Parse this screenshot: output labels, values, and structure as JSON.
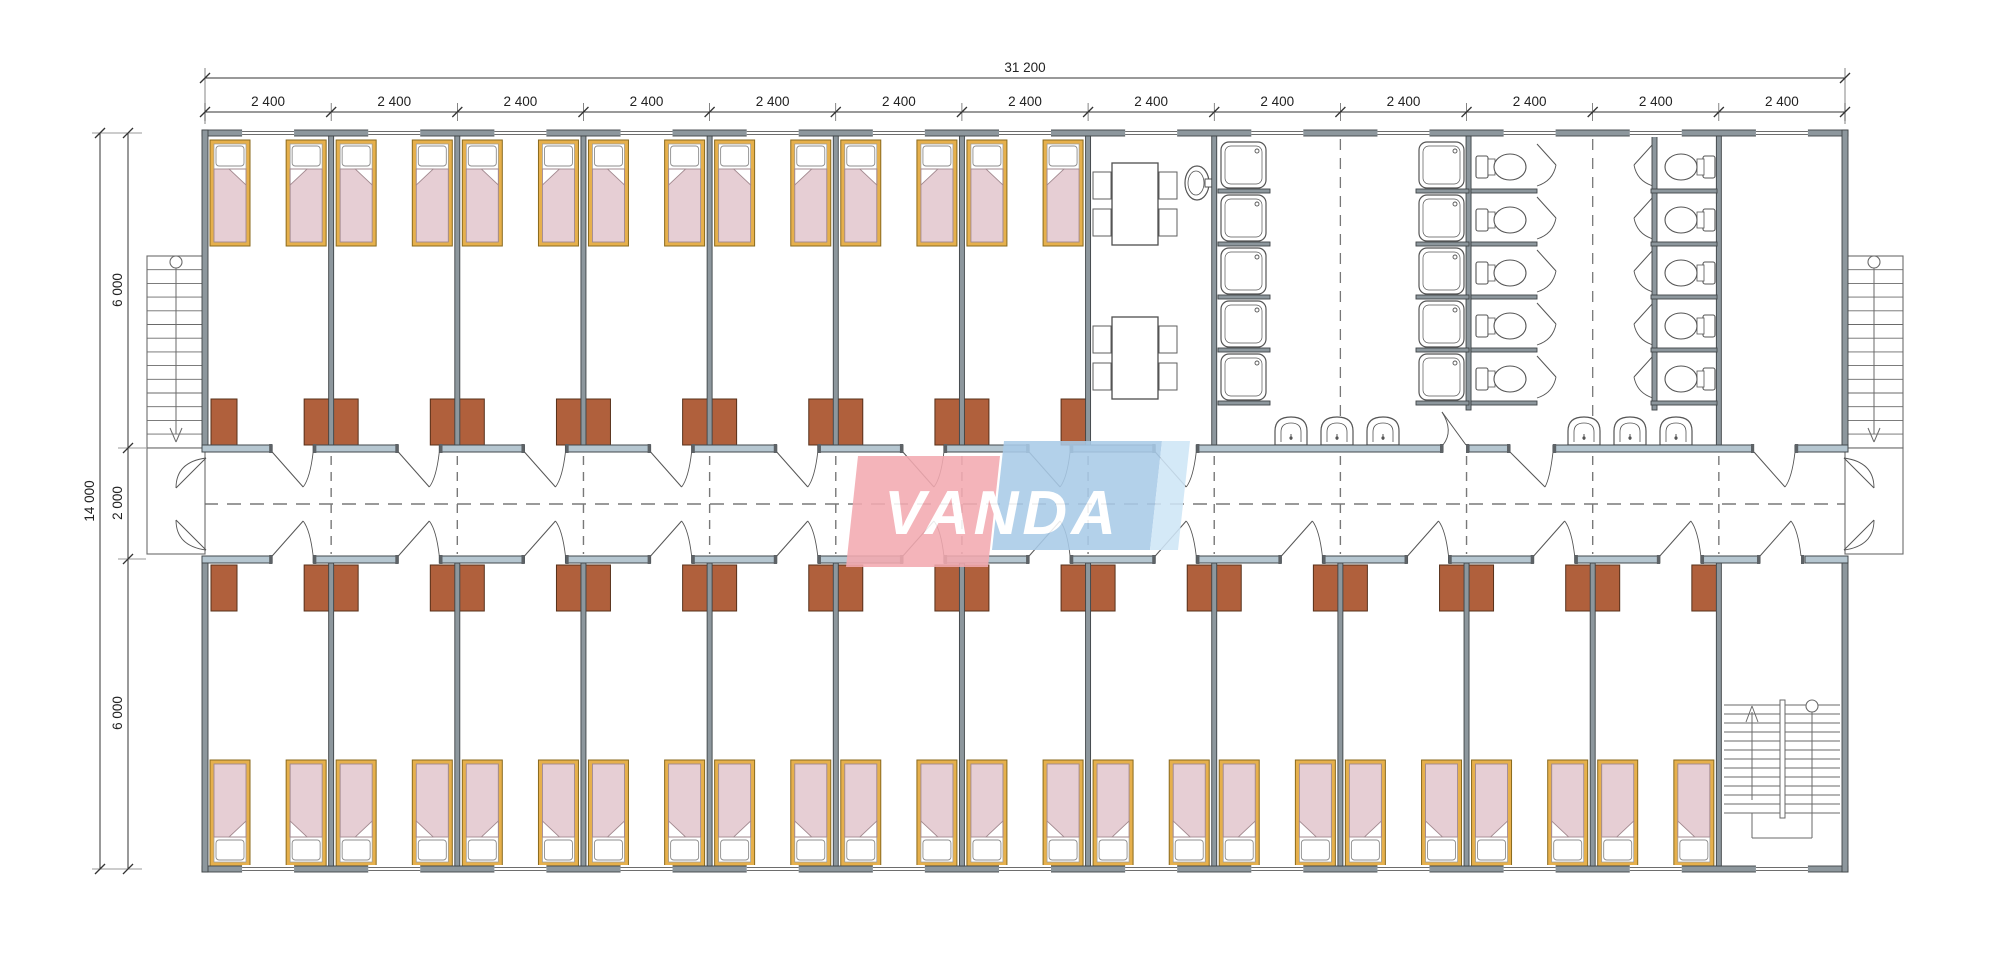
{
  "page": {
    "background": "#ffffff",
    "description": "architectural floor plan of modular dormitory building"
  },
  "logo": {
    "text": "VANDA",
    "red": "#f3aab1",
    "blue": "#a9cbe8",
    "light_blue": "#cfe6f7"
  },
  "dimensions": {
    "top_total": "31 200",
    "modules": [
      "2 400",
      "2 400",
      "2 400",
      "2 400",
      "2 400",
      "2 400",
      "2 400",
      "2 400",
      "2 400",
      "2 400",
      "2 400",
      "2 400",
      "2 400"
    ],
    "left_total": "14 000",
    "left_chain": [
      "6 000",
      "2 000",
      "6 000"
    ]
  },
  "plan": {
    "module_count": 13,
    "top_zone": {
      "bedrooms": 7,
      "beds": 14,
      "dining_tables": 2,
      "chairs_per_table": 4,
      "shower_stalls": 10,
      "toilet_stalls": 10,
      "wall_basins": 6,
      "dining_basin": 1,
      "end_room": 1
    },
    "bottom_zone": {
      "bedrooms": 12,
      "beds": 24,
      "stair_room": 1
    },
    "wardrobes_top": 14,
    "wardrobes_bottom": 24,
    "exterior_stairs": 2,
    "interior_stairs": 1,
    "corridor": {
      "width_label": "2 000"
    }
  },
  "colors": {
    "wall": "#8d979d",
    "wall_stroke": "#3f4447",
    "corridor_wall": "#b5c6d0",
    "bed_frame": "#e6b04c",
    "bed_frame_stroke": "#8a6a1e",
    "blanket": "#e6ced4",
    "blanket_stroke": "#a2898f",
    "wardrobe": "#b0603c",
    "wardrobe_stroke": "#57301a",
    "fixture": "#555555",
    "dash": "#787878",
    "dim": "#333333",
    "stair": "#6a6a6a"
  }
}
